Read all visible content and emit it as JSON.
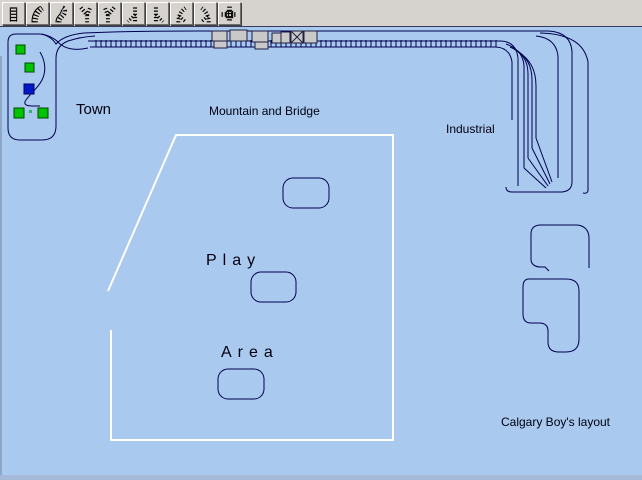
{
  "toolbar": {
    "buttons": [
      {
        "icon": "straight-track-icon"
      },
      {
        "icon": "curve-track-icon"
      },
      {
        "icon": "double-curve-track-icon"
      },
      {
        "icon": "wye-left-track-icon"
      },
      {
        "icon": "wye-right-track-icon"
      },
      {
        "icon": "turnout-left-track-icon"
      },
      {
        "icon": "turnout-right-track-icon"
      },
      {
        "icon": "curved-turnout-left-track-icon"
      },
      {
        "icon": "curved-turnout-right-track-icon"
      },
      {
        "icon": "crossing-track-icon"
      }
    ]
  },
  "canvas": {
    "labels": {
      "town": "Town",
      "mountain_and_bridge": "Mountain and Bridge",
      "industrial": "Industrial",
      "play": "P l a y",
      "area": "A r e a",
      "layout_name": "Calgary Boy's layout"
    },
    "colors": {
      "canvas_background": "#a9c9ee",
      "track": "#000050",
      "play_area_outline": "#ffffff",
      "building_fill": "#c9c9c9",
      "town_square_green": "#00c400",
      "town_square_blue": "#0018c8"
    },
    "object_counts": {
      "green_town_squares": 4,
      "blue_town_squares": 1,
      "play_area_pads": 3,
      "trackside_buildings": 8
    }
  }
}
